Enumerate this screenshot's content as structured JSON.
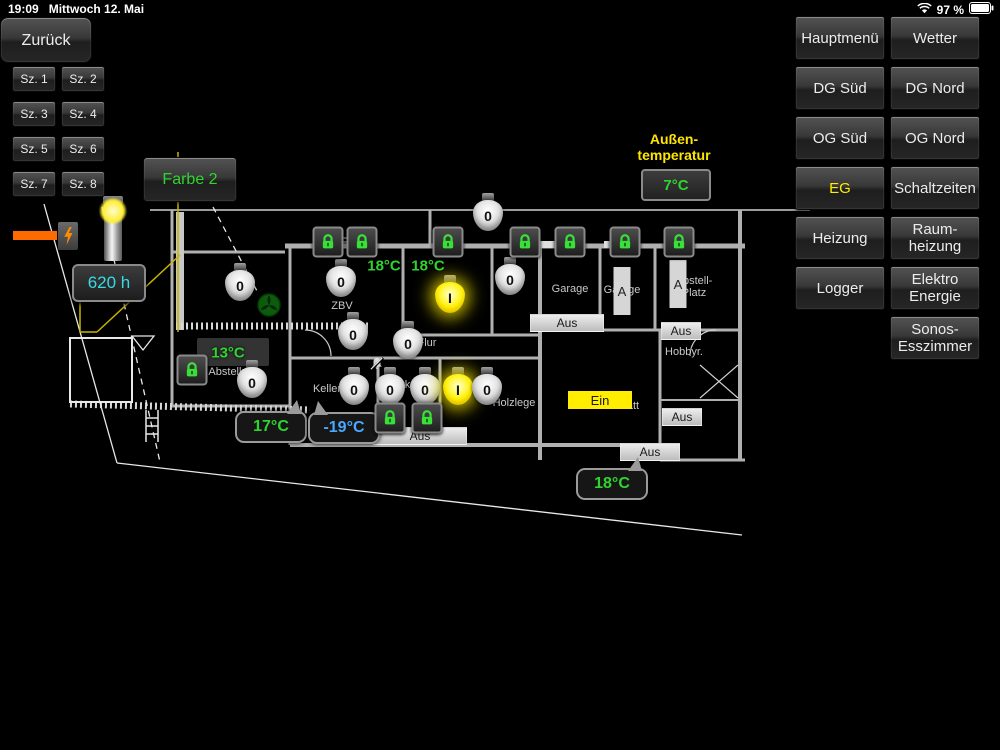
{
  "status_bar": {
    "time": "19:09",
    "date": "Mittwoch 12. Mai",
    "battery_pct": "97 %"
  },
  "back_button": "Zurück",
  "scenes": [
    "Sz. 1",
    "Sz. 2",
    "Sz. 3",
    "Sz. 4",
    "Sz. 5",
    "Sz. 6",
    "Sz. 7",
    "Sz. 8"
  ],
  "farbe_button": {
    "label": "Farbe 2",
    "color": "#2ed52e"
  },
  "outdoor_temp": {
    "label": "Außen-\ntemperatur",
    "value": "7°C",
    "label_color": "#ffe600",
    "value_color": "#2ed52e"
  },
  "runtime_counter": {
    "value": "620 h",
    "color": "#35dce8"
  },
  "menu": {
    "accent_active": "#ffee00",
    "items": [
      {
        "label": "Hauptmenü"
      },
      {
        "label": "Wetter"
      },
      {
        "label": "DG Süd"
      },
      {
        "label": "DG Nord"
      },
      {
        "label": "OG Süd"
      },
      {
        "label": "OG Nord"
      },
      {
        "label": "EG",
        "active": true
      },
      {
        "label": "Schaltzeiten"
      },
      {
        "label": "Heizung"
      },
      {
        "label": "Raum-\nheizung"
      },
      {
        "label": "Logger"
      },
      {
        "label": "Elektro\nEnergie"
      },
      {
        "label": null
      },
      {
        "label": "Sonos-\nEsszimmer"
      }
    ]
  },
  "plan": {
    "bulbs": [
      {
        "x": 240,
        "y": 282,
        "value": "0",
        "on": false
      },
      {
        "x": 341,
        "y": 278,
        "value": "0",
        "on": false
      },
      {
        "x": 488,
        "y": 212,
        "value": "0",
        "on": false
      },
      {
        "x": 510,
        "y": 276,
        "value": "0",
        "on": false
      },
      {
        "x": 450,
        "y": 294,
        "value": "I",
        "on": true
      },
      {
        "x": 353,
        "y": 331,
        "value": "0",
        "on": false
      },
      {
        "x": 408,
        "y": 340,
        "value": "0",
        "on": false
      },
      {
        "x": 252,
        "y": 379,
        "value": "0",
        "on": false
      },
      {
        "x": 354,
        "y": 386,
        "value": "0",
        "on": false
      },
      {
        "x": 390,
        "y": 386,
        "value": "0",
        "on": false
      },
      {
        "x": 425,
        "y": 386,
        "value": "0",
        "on": false
      },
      {
        "x": 458,
        "y": 386,
        "value": "I",
        "on": true
      },
      {
        "x": 487,
        "y": 386,
        "value": "0",
        "on": false
      }
    ],
    "locks": [
      {
        "x": 328,
        "y": 242
      },
      {
        "x": 362,
        "y": 242
      },
      {
        "x": 448,
        "y": 242
      },
      {
        "x": 525,
        "y": 242
      },
      {
        "x": 570,
        "y": 242
      },
      {
        "x": 625,
        "y": 242
      },
      {
        "x": 679,
        "y": 242
      },
      {
        "x": 192,
        "y": 370
      },
      {
        "x": 390,
        "y": 418
      },
      {
        "x": 427,
        "y": 418
      }
    ],
    "temp_panels": [
      {
        "x": 233,
        "y": 352,
        "w": 72,
        "h": 28
      }
    ],
    "temps": [
      {
        "x": 384,
        "y": 266,
        "value": "18°C",
        "color": "#2ed52e"
      },
      {
        "x": 428,
        "y": 266,
        "value": "18°C",
        "color": "#2ed52e"
      },
      {
        "x": 228,
        "y": 353,
        "value": "13°C",
        "color": "#2ed52e"
      }
    ],
    "temp_bubbles": [
      {
        "x": 271,
        "y": 427,
        "value": "17°C",
        "color": "#2ed52e",
        "tail": "right"
      },
      {
        "x": 344,
        "y": 428,
        "value": "-19°C",
        "color": "#4aa8ff",
        "tail": "left"
      },
      {
        "x": 612,
        "y": 484,
        "value": "18°C",
        "color": "#2ed52e",
        "tail": "right"
      }
    ],
    "statuses": [
      {
        "x": 567,
        "y": 323,
        "w": 72,
        "text": "Aus",
        "kind": "aus"
      },
      {
        "x": 420,
        "y": 436,
        "w": 92,
        "text": "Aus",
        "kind": "aus"
      },
      {
        "x": 650,
        "y": 452,
        "w": 58,
        "text": "Aus",
        "kind": "aus"
      },
      {
        "x": 681,
        "y": 331,
        "w": 38,
        "text": "Aus",
        "kind": "aus"
      },
      {
        "x": 682,
        "y": 417,
        "w": 38,
        "text": "Aus",
        "kind": "aus"
      },
      {
        "x": 600,
        "y": 400,
        "w": 64,
        "text": "Ein",
        "kind": "ein"
      }
    ],
    "rooms": [
      {
        "x": 342,
        "y": 306,
        "text": "ZBV"
      },
      {
        "x": 570,
        "y": 289,
        "text": "Garage"
      },
      {
        "x": 622,
        "y": 290,
        "text": "Garage"
      },
      {
        "x": 694,
        "y": 287,
        "text": "Abstell-\nPlatz"
      },
      {
        "x": 427,
        "y": 343,
        "text": "Flur"
      },
      {
        "x": 228,
        "y": 372,
        "text": "Abstellr."
      },
      {
        "x": 327,
        "y": 389,
        "text": "Keller"
      },
      {
        "x": 399,
        "y": 385,
        "text": "Werk."
      },
      {
        "x": 514,
        "y": 403,
        "text": "Holzlege"
      },
      {
        "x": 684,
        "y": 352,
        "text": "Hobbyr."
      },
      {
        "x": 616,
        "y": 406,
        "text": "Werkstatt"
      }
    ],
    "door_indicators": [
      {
        "x": 622,
        "y": 291,
        "label": "A"
      },
      {
        "x": 678,
        "y": 284,
        "label": "A"
      }
    ],
    "fan_icon": {
      "x": 269,
      "y": 305
    },
    "muted_icon": {
      "x": 377,
      "y": 364
    }
  }
}
